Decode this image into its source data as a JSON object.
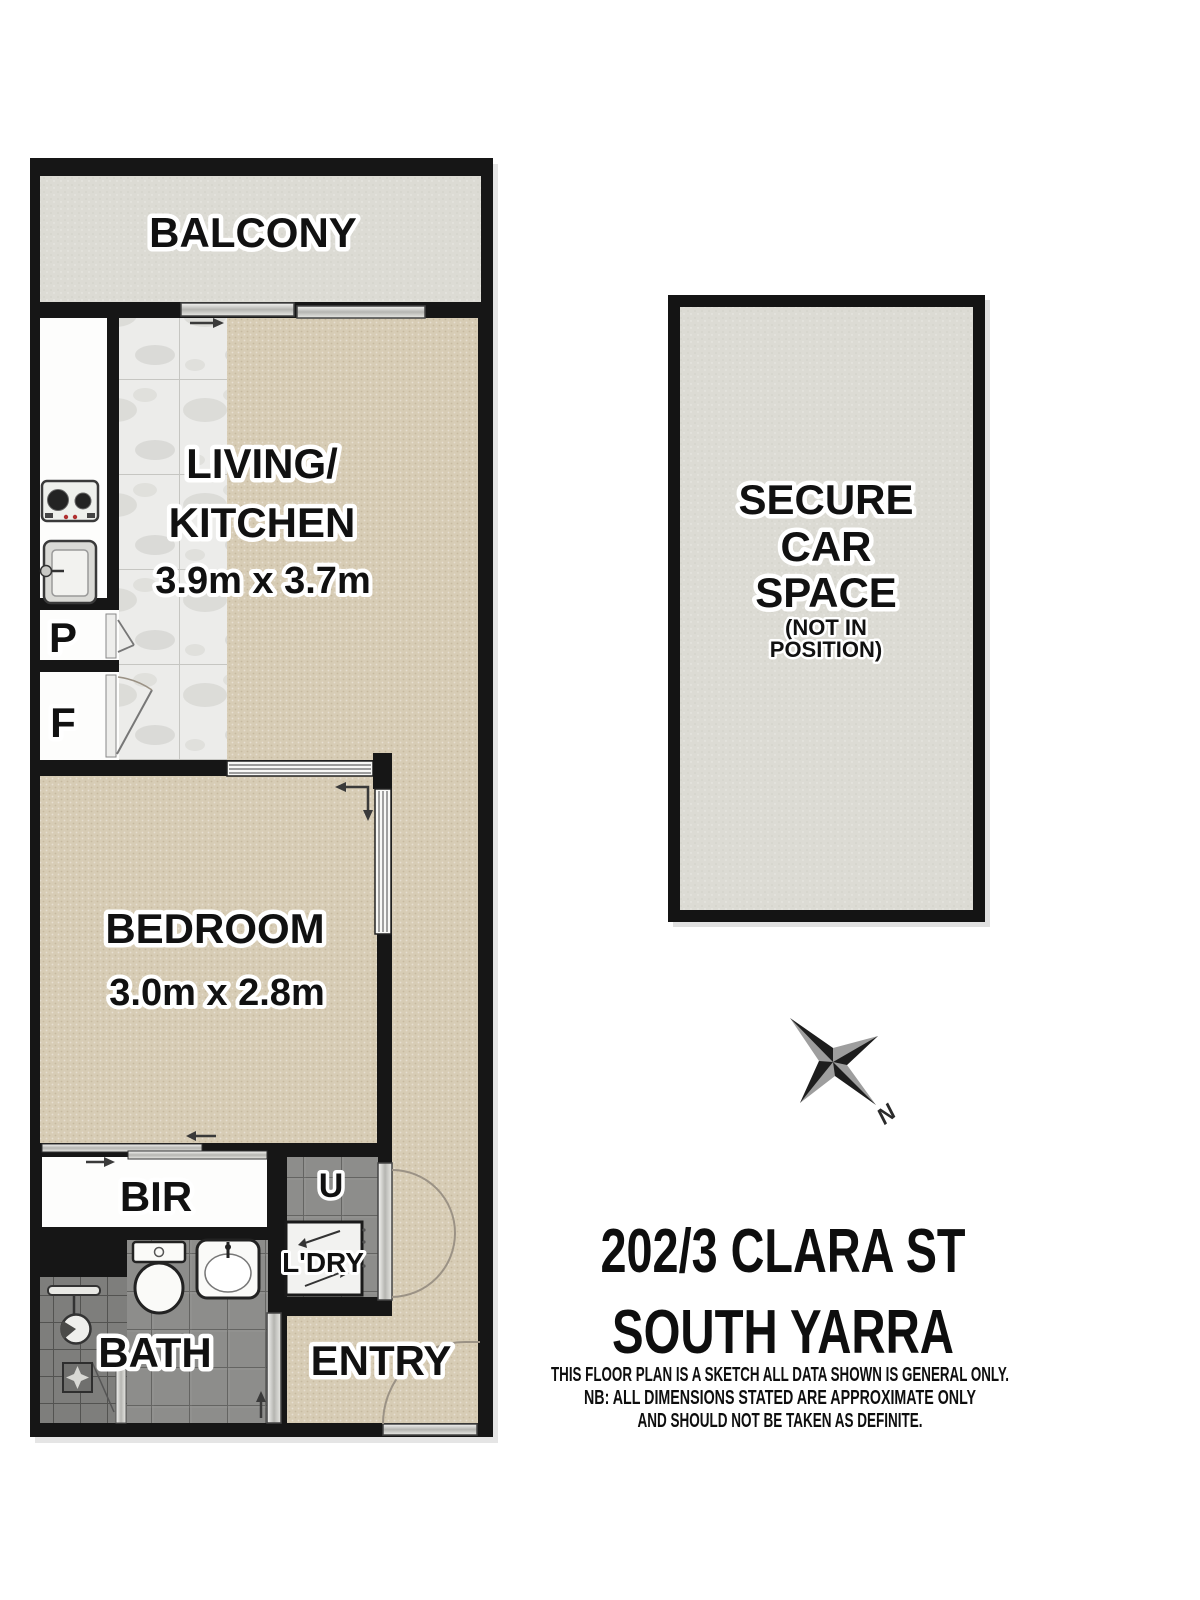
{
  "rooms": {
    "balcony": "BALCONY",
    "living_kitchen_line1": "LIVING/",
    "living_kitchen_line2": "KITCHEN",
    "living_kitchen_dims": "3.9m x 3.7m",
    "bedroom": "BEDROOM",
    "bedroom_dims": "3.0m x 2.8m",
    "bir": "BIR",
    "bath": "BATH",
    "entry": "ENTRY",
    "laundry": "L'DRY",
    "utility": "U",
    "pantry": "P",
    "fridge": "F"
  },
  "car_space": {
    "line1": "SECURE",
    "line2": "CAR",
    "line3": "SPACE",
    "line4": "(NOT IN",
    "line5": "POSITION)"
  },
  "compass": {
    "north": "N"
  },
  "address": {
    "line1": "202/3 CLARA ST",
    "line2": "SOUTH YARRA",
    "disclaimer1": "THIS FLOOR PLAN IS A SKETCH ALL DATA SHOWN IS GENERAL ONLY.",
    "disclaimer2": "NB: ALL DIMENSIONS STATED ARE APPROXIMATE ONLY",
    "disclaimer3": "AND SHOULD NOT BE TAKEN AS DEFINITE."
  },
  "colors": {
    "wall": "#161616",
    "carpet": "#d7ccb5",
    "kitchen_tile": "#ececea",
    "hard_floor_gray": "#dcdbd4",
    "bath_tile": "#8d8d8b",
    "door_arc": "#9b9285"
  }
}
